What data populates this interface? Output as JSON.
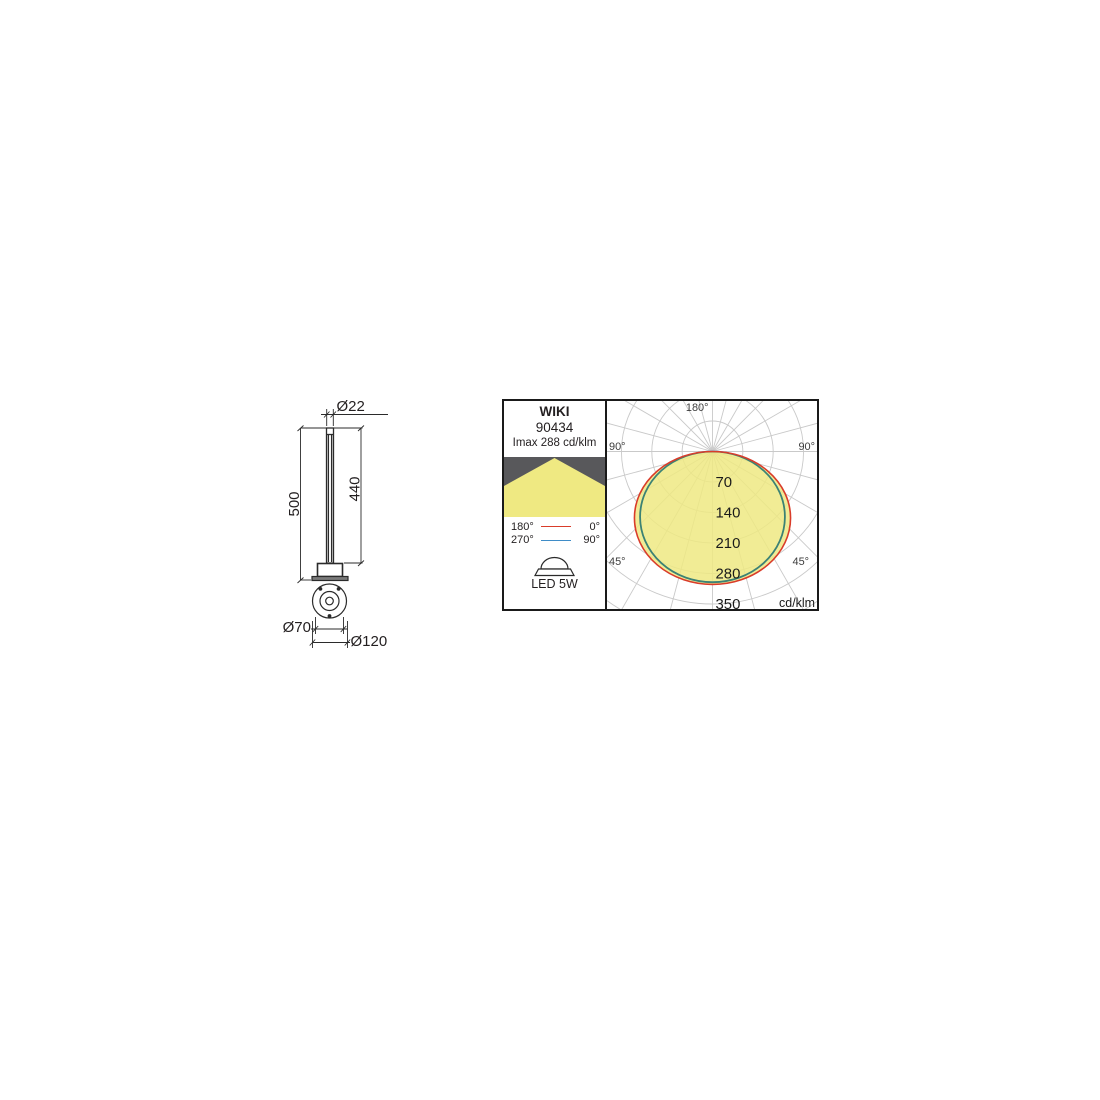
{
  "drawing": {
    "labels": {
      "top_diameter": "Ø22",
      "overall_height": "500",
      "pole_height": "440",
      "bolt_circle_diameter": "Ø70",
      "base_diameter": "Ø120"
    }
  },
  "photometry": {
    "model": "WIKI",
    "article": "90434",
    "imax": "Imax 288 cd/klm",
    "lamp": "LED 5W",
    "legend": [
      {
        "left": "180°",
        "right": "0°",
        "color": "#d93c2a"
      },
      {
        "left": "270°",
        "right": "90°",
        "color": "#3f8cc7"
      }
    ],
    "chart_data": {
      "type": "polar",
      "unit": "cd/klm",
      "rings": [
        70,
        140,
        210,
        280,
        350
      ],
      "ring_step": 70,
      "max_grid_ring": 420,
      "angle_step_deg": 15,
      "angle_labels": {
        "top": "180°",
        "left": "90°",
        "right": "90°",
        "lower_left": "45°",
        "lower_right": "45°"
      },
      "series": [
        {
          "name": "plane 180°–0°",
          "color": "#d93c2a",
          "peak_cd_klm": 305,
          "half_width_cd_klm": 180
        },
        {
          "name": "plane 270°–90°",
          "color": "#3f8cc7",
          "peak_cd_klm": 300,
          "half_width_cd_klm": 167
        }
      ],
      "fill_color": "#efe982",
      "grid_color": "#c9c9c9"
    }
  }
}
